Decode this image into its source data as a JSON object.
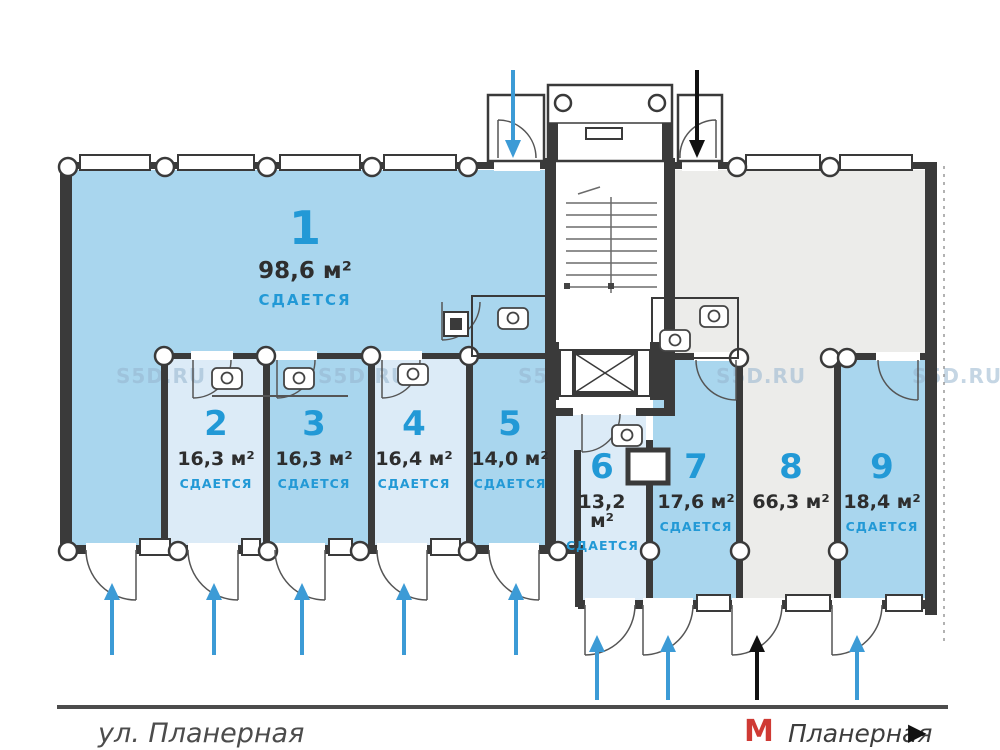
{
  "rooms": [
    {
      "number": "1",
      "area": "98,6 м²",
      "status": "СДАЕТСЯ"
    },
    {
      "number": "2",
      "area": "16,3 м²",
      "status": "СДАЕТСЯ"
    },
    {
      "number": "3",
      "area": "16,3 м²",
      "status": "СДАЕТСЯ"
    },
    {
      "number": "4",
      "area": "16,4 м²",
      "status": "СДАЕТСЯ"
    },
    {
      "number": "5",
      "area": "14,0 м²",
      "status": "СДАЕТСЯ"
    },
    {
      "number": "6",
      "area": "13,2 м²",
      "status": "СДАЕТСЯ"
    },
    {
      "number": "7",
      "area": "17,6 м²",
      "status": "СДАЕТСЯ"
    },
    {
      "number": "8",
      "area": "66,3 м²"
    },
    {
      "number": "9",
      "area": "18,4 м²",
      "status": "СДАЕТСЯ"
    }
  ],
  "watermark": {
    "text": "S5D.RU"
  },
  "footer": {
    "street": "ул. Планерная",
    "metro_logo": "М",
    "metro_station": "Планерная",
    "direction_arrow": "▶"
  },
  "colors": {
    "room_blue": "#a9d6ee",
    "room_light": "#dcebf7",
    "room_gray": "#ececea",
    "accent_blue": "#2299d6",
    "arrow_blue": "#3c9bd6",
    "arrow_black": "#111111",
    "wall": "#3a3a3a",
    "metro_red": "#cf3a34"
  }
}
